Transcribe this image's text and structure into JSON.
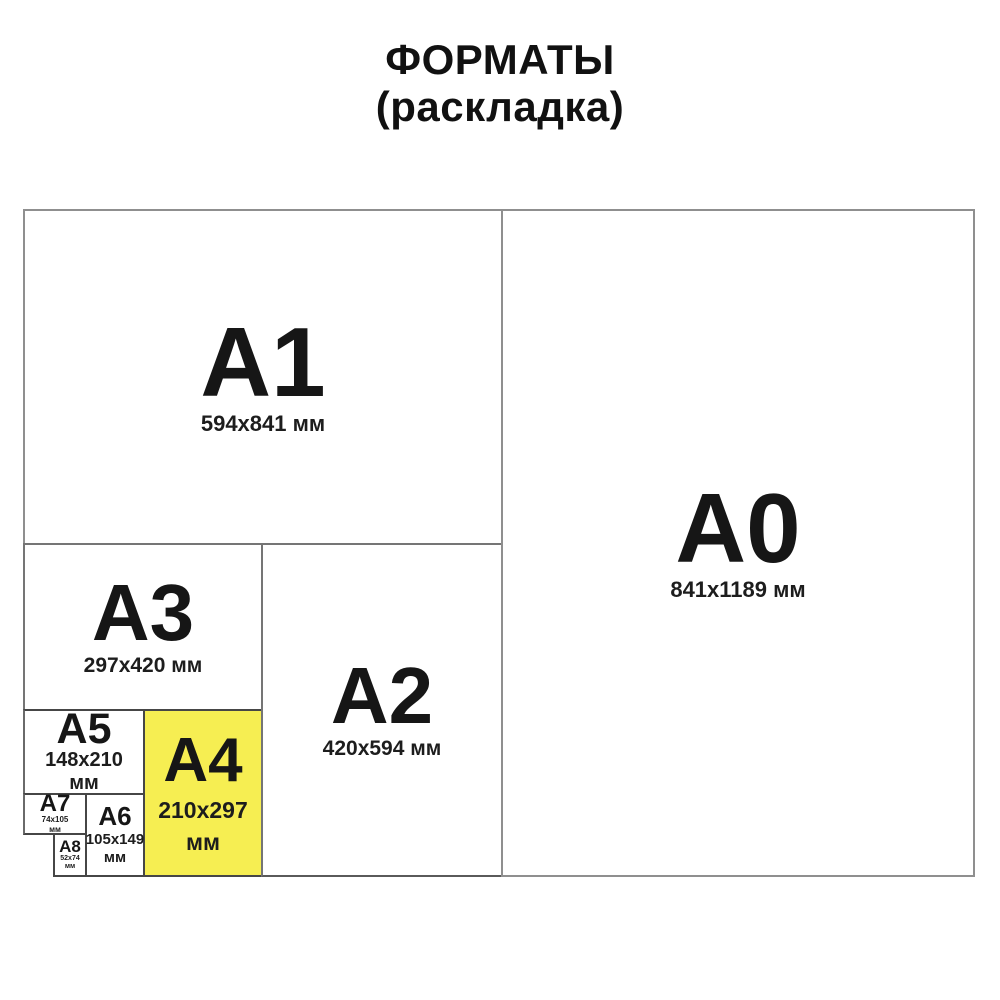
{
  "title": {
    "line1": "ФОРМАТЫ",
    "line2": "(раскладка)"
  },
  "sheets": {
    "a0": {
      "label": "A0",
      "dims": "841x1189 мм"
    },
    "a1": {
      "label": "A1",
      "dims": "594x841 мм"
    },
    "a2": {
      "label": "A2",
      "dims": "420x594 мм"
    },
    "a3": {
      "label": "A3",
      "dims": "297x420 мм"
    },
    "a4": {
      "label": "A4",
      "dims_line1": "210x297",
      "dims_line2": "мм",
      "highlighted": true
    },
    "a5": {
      "label": "A5",
      "dims_line1": "148x210",
      "dims_line2": "мм"
    },
    "a6": {
      "label": "A6",
      "dims_line1": "105x149",
      "dims_line2": "мм"
    },
    "a7": {
      "label": "A7",
      "dims_line1": "74x105",
      "dims_line2": "мм"
    },
    "a8": {
      "label": "A8",
      "dims_line1": "52x74",
      "dims_line2": "мм"
    }
  },
  "colors": {
    "highlight": "#f6ee52",
    "border_outer": "#8f8f8f",
    "border_mid": "#757575",
    "border_inner": "#464646",
    "text": "#111111"
  }
}
